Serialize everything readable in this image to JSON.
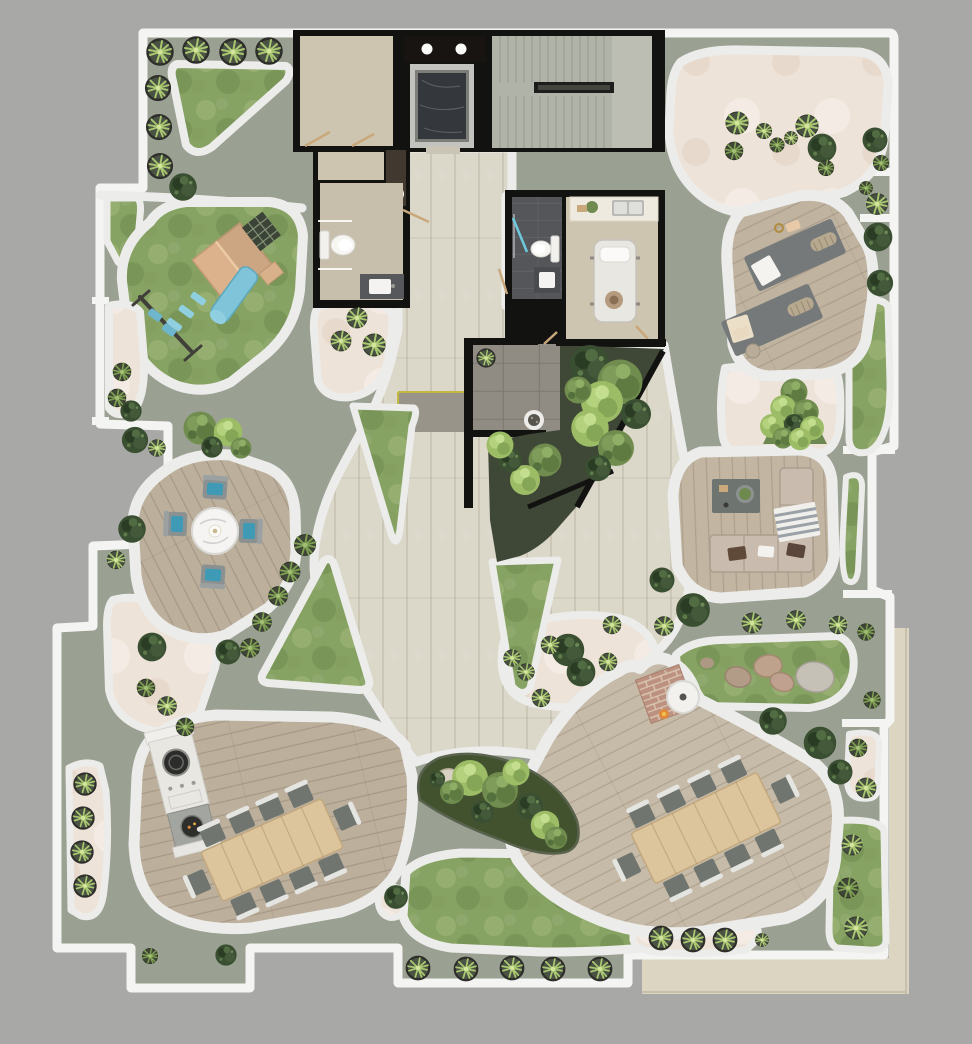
{
  "canvas": {
    "width": 972,
    "height": 1044
  },
  "colors": {
    "background": "#a8a8a6",
    "outside_roof": "#dcd5c2",
    "parapet": "#f4f4f2",
    "terrace_floor": "#9aa092",
    "walkway": "#ececea",
    "paver": "#dbd7c9",
    "sand": "#eee3d8",
    "lawn": "#87a364",
    "deck_wood": "#bcb09d",
    "deck_wood_light": "#c6bba8",
    "table_wood": "#dcc49c",
    "building_wall": "#121211",
    "room_beige": "#cec5b0",
    "room_beige_2": "#c7beab",
    "slate": "#54565a",
    "stair": "#b0b3a7",
    "court_tile": "#908c83",
    "soil": "#3f4836",
    "marble_dark": "#34373b",
    "metal": "#c2c2bf",
    "chair_gray": "#70756f",
    "cushion_blue": "#3f9ab5",
    "accent_blue": "#7fc4d8",
    "sofa": "#c9bcae",
    "white_furniture": "#f2f1ee",
    "brick": "#bd9180",
    "boulder_tan": "#b79c88",
    "boulder_gray": "#c6c1b6",
    "accent_yellow": "#c3b93f"
  },
  "scene": {
    "description": "top-down architectural rendering of a rooftop amenity terrace around a central building core",
    "areas": [
      {
        "id": "building-core",
        "kind": "interior"
      },
      {
        "id": "elevator",
        "kind": "interior"
      },
      {
        "id": "staircase",
        "kind": "interior"
      },
      {
        "id": "bathroom-left",
        "kind": "interior"
      },
      {
        "id": "bathroom-slate",
        "kind": "interior"
      },
      {
        "id": "treatment-room",
        "kind": "interior"
      },
      {
        "id": "outdoor-shower-court",
        "kind": "patio"
      },
      {
        "id": "walled-garden",
        "kind": "planting"
      },
      {
        "id": "central-paver-plaza",
        "kind": "paving"
      },
      {
        "id": "playground-lawn",
        "kind": "lawn"
      },
      {
        "id": "round-dining-deck",
        "kind": "deck"
      },
      {
        "id": "bbq-dining-deck",
        "kind": "deck"
      },
      {
        "id": "fire-pit-dining-deck",
        "kind": "deck"
      },
      {
        "id": "lounge-deck",
        "kind": "deck"
      },
      {
        "id": "yoga-deck",
        "kind": "deck"
      },
      {
        "id": "zen-sand-garden",
        "kind": "sand"
      },
      {
        "id": "rock-garden-lawn",
        "kind": "lawn"
      },
      {
        "id": "bottom-lawn",
        "kind": "lawn"
      },
      {
        "id": "teardrop-planting-bed",
        "kind": "planting"
      }
    ],
    "furniture": [
      "playhouse-with-slide",
      "swing-set",
      "round-marble-table",
      "four-blue-cushion-chairs",
      "bbq-island",
      "dining-table-10-seats-west",
      "dining-table-10-seats-east",
      "fire-pit-table",
      "l-shaped-sofa",
      "coffee-table",
      "two-yoga-mats",
      "massage-table",
      "kitchenette",
      "toilet-x2",
      "vanity-x2",
      "shower-drain"
    ],
    "plants": [
      {
        "type": "pota",
        "x": 160,
        "y": 52,
        "s": 1
      },
      {
        "type": "pota",
        "x": 196,
        "y": 50,
        "s": 1
      },
      {
        "type": "pota",
        "x": 233,
        "y": 52,
        "s": 1
      },
      {
        "type": "pota",
        "x": 269,
        "y": 51,
        "s": 1
      },
      {
        "type": "pota",
        "x": 158,
        "y": 88,
        "s": 0.95
      },
      {
        "type": "pota",
        "x": 159,
        "y": 127,
        "s": 0.95
      },
      {
        "type": "pota",
        "x": 160,
        "y": 166,
        "s": 0.95
      },
      {
        "type": "bush",
        "x": 183,
        "y": 187,
        "s": 1.1
      },
      {
        "type": "agaved",
        "x": 122,
        "y": 372,
        "s": 0.8
      },
      {
        "type": "agaved",
        "x": 117,
        "y": 398,
        "s": 0.8
      },
      {
        "type": "bush",
        "x": 131,
        "y": 411,
        "s": 0.85
      },
      {
        "type": "bush",
        "x": 135,
        "y": 440,
        "s": 1.05
      },
      {
        "type": "agave",
        "x": 157,
        "y": 448,
        "s": 0.75
      },
      {
        "type": "treeo",
        "x": 200,
        "y": 428,
        "s": 1.1
      },
      {
        "type": "treel",
        "x": 228,
        "y": 432,
        "s": 0.95
      },
      {
        "type": "bush",
        "x": 212,
        "y": 447,
        "s": 0.85
      },
      {
        "type": "treeo",
        "x": 241,
        "y": 448,
        "s": 0.7
      },
      {
        "type": "agave",
        "x": 357,
        "y": 318,
        "s": 0.9
      },
      {
        "type": "agave",
        "x": 341,
        "y": 341,
        "s": 0.9
      },
      {
        "type": "agave",
        "x": 374,
        "y": 345,
        "s": 1
      },
      {
        "type": "agaved",
        "x": 305,
        "y": 545,
        "s": 0.95
      },
      {
        "type": "agaved",
        "x": 290,
        "y": 572,
        "s": 0.9
      },
      {
        "type": "agaved",
        "x": 278,
        "y": 596,
        "s": 0.85
      },
      {
        "type": "agaved",
        "x": 262,
        "y": 622,
        "s": 0.85
      },
      {
        "type": "agaved",
        "x": 250,
        "y": 648,
        "s": 0.85
      },
      {
        "type": "bush",
        "x": 228,
        "y": 652,
        "s": 1
      },
      {
        "type": "bush",
        "x": 132,
        "y": 529,
        "s": 1.1
      },
      {
        "type": "agave",
        "x": 116,
        "y": 560,
        "s": 0.8
      },
      {
        "type": "bush",
        "x": 152,
        "y": 647,
        "s": 1.15
      },
      {
        "type": "agaved",
        "x": 146,
        "y": 688,
        "s": 0.8
      },
      {
        "type": "agave",
        "x": 167,
        "y": 706,
        "s": 0.85
      },
      {
        "type": "agaved",
        "x": 185,
        "y": 727,
        "s": 0.8
      },
      {
        "type": "pota",
        "x": 85,
        "y": 784,
        "s": 0.85
      },
      {
        "type": "pota",
        "x": 83,
        "y": 818,
        "s": 0.85
      },
      {
        "type": "pota",
        "x": 82,
        "y": 852,
        "s": 0.85
      },
      {
        "type": "pota",
        "x": 85,
        "y": 886,
        "s": 0.85
      },
      {
        "type": "bush",
        "x": 226,
        "y": 955,
        "s": 0.85
      },
      {
        "type": "agaved",
        "x": 150,
        "y": 956,
        "s": 0.7
      },
      {
        "type": "bush",
        "x": 590,
        "y": 365,
        "s": 1.6
      },
      {
        "type": "treeo",
        "x": 620,
        "y": 382,
        "s": 1.5
      },
      {
        "type": "treel",
        "x": 602,
        "y": 402,
        "s": 1.4
      },
      {
        "type": "bush",
        "x": 636,
        "y": 414,
        "s": 1.2
      },
      {
        "type": "treel",
        "x": 590,
        "y": 428,
        "s": 1.25
      },
      {
        "type": "treeo",
        "x": 616,
        "y": 448,
        "s": 1.2
      },
      {
        "type": "bush",
        "x": 598,
        "y": 468,
        "s": 1.05
      },
      {
        "type": "treeo",
        "x": 578,
        "y": 390,
        "s": 0.9
      },
      {
        "type": "treeo",
        "x": 545,
        "y": 460,
        "s": 1.1
      },
      {
        "type": "treel",
        "x": 525,
        "y": 480,
        "s": 1
      },
      {
        "type": "bush",
        "x": 510,
        "y": 460,
        "s": 0.95
      },
      {
        "type": "treel",
        "x": 500,
        "y": 445,
        "s": 0.9
      },
      {
        "type": "treel",
        "x": 470,
        "y": 778,
        "s": 1.2
      },
      {
        "type": "treeo",
        "x": 500,
        "y": 790,
        "s": 1.2
      },
      {
        "type": "bush",
        "x": 530,
        "y": 806,
        "s": 1.05
      },
      {
        "type": "treel",
        "x": 545,
        "y": 825,
        "s": 0.95
      },
      {
        "type": "treeo",
        "x": 452,
        "y": 792,
        "s": 0.8
      },
      {
        "type": "bush",
        "x": 482,
        "y": 812,
        "s": 0.9
      },
      {
        "type": "treel",
        "x": 516,
        "y": 772,
        "s": 0.9
      },
      {
        "type": "treeo",
        "x": 556,
        "y": 838,
        "s": 0.75
      },
      {
        "type": "bush",
        "x": 437,
        "y": 779,
        "s": 0.65
      },
      {
        "type": "bush",
        "x": 396,
        "y": 897,
        "s": 0.95
      },
      {
        "type": "pota",
        "x": 418,
        "y": 968,
        "s": 0.9
      },
      {
        "type": "pota",
        "x": 466,
        "y": 969,
        "s": 0.9
      },
      {
        "type": "pota",
        "x": 512,
        "y": 968,
        "s": 0.9
      },
      {
        "type": "pota",
        "x": 553,
        "y": 969,
        "s": 0.9
      },
      {
        "type": "pota",
        "x": 600,
        "y": 969,
        "s": 0.9
      },
      {
        "type": "pota",
        "x": 661,
        "y": 938,
        "s": 0.9
      },
      {
        "type": "pota",
        "x": 693,
        "y": 940,
        "s": 0.9
      },
      {
        "type": "pota",
        "x": 725,
        "y": 940,
        "s": 0.9
      },
      {
        "type": "agave",
        "x": 762,
        "y": 940,
        "s": 0.6
      },
      {
        "type": "bush",
        "x": 568,
        "y": 650,
        "s": 1.3
      },
      {
        "type": "bush",
        "x": 581,
        "y": 672,
        "s": 1.15
      },
      {
        "type": "agave",
        "x": 612,
        "y": 625,
        "s": 0.8
      },
      {
        "type": "agave",
        "x": 550,
        "y": 645,
        "s": 0.8
      },
      {
        "type": "agave",
        "x": 608,
        "y": 662,
        "s": 0.8
      },
      {
        "type": "agave",
        "x": 526,
        "y": 672,
        "s": 0.75
      },
      {
        "type": "agave",
        "x": 541,
        "y": 698,
        "s": 0.8
      },
      {
        "type": "agave",
        "x": 512,
        "y": 658,
        "s": 0.75
      },
      {
        "type": "bush",
        "x": 662,
        "y": 580,
        "s": 1
      },
      {
        "type": "bush",
        "x": 693,
        "y": 610,
        "s": 1.35
      },
      {
        "type": "agave",
        "x": 664,
        "y": 626,
        "s": 0.85
      },
      {
        "type": "agave",
        "x": 752,
        "y": 623,
        "s": 0.9
      },
      {
        "type": "agave",
        "x": 796,
        "y": 620,
        "s": 0.85
      },
      {
        "type": "agave",
        "x": 838,
        "y": 625,
        "s": 0.8
      },
      {
        "type": "agaved",
        "x": 866,
        "y": 632,
        "s": 0.75
      },
      {
        "type": "bush",
        "x": 773,
        "y": 721,
        "s": 1.1
      },
      {
        "type": "bush",
        "x": 820,
        "y": 743,
        "s": 1.3
      },
      {
        "type": "bush",
        "x": 840,
        "y": 772,
        "s": 1
      },
      {
        "type": "agaved",
        "x": 872,
        "y": 700,
        "s": 0.75
      },
      {
        "type": "agaved",
        "x": 858,
        "y": 748,
        "s": 0.8
      },
      {
        "type": "agave",
        "x": 866,
        "y": 788,
        "s": 0.9
      },
      {
        "type": "agave",
        "x": 852,
        "y": 845,
        "s": 0.9
      },
      {
        "type": "agaved",
        "x": 848,
        "y": 888,
        "s": 0.9
      },
      {
        "type": "agave",
        "x": 856,
        "y": 928,
        "s": 1
      },
      {
        "type": "agave",
        "x": 737,
        "y": 123,
        "s": 1
      },
      {
        "type": "agave",
        "x": 764,
        "y": 131,
        "s": 0.7
      },
      {
        "type": "agave",
        "x": 807,
        "y": 126,
        "s": 1
      },
      {
        "type": "agaved",
        "x": 777,
        "y": 145,
        "s": 0.65
      },
      {
        "type": "agave",
        "x": 791,
        "y": 138,
        "s": 0.6
      },
      {
        "type": "bush",
        "x": 822,
        "y": 148,
        "s": 1.15
      },
      {
        "type": "agaved",
        "x": 734,
        "y": 151,
        "s": 0.8
      },
      {
        "type": "agaved",
        "x": 826,
        "y": 168,
        "s": 0.7
      },
      {
        "type": "bush",
        "x": 875,
        "y": 140,
        "s": 1
      },
      {
        "type": "agaved",
        "x": 881,
        "y": 163,
        "s": 0.7
      },
      {
        "type": "agaved",
        "x": 866,
        "y": 188,
        "s": 0.6
      },
      {
        "type": "agave",
        "x": 877,
        "y": 204,
        "s": 0.95
      },
      {
        "type": "bush",
        "x": 878,
        "y": 237,
        "s": 1.15
      },
      {
        "type": "bush",
        "x": 880,
        "y": 283,
        "s": 1.05
      },
      {
        "type": "treeo",
        "x": 794,
        "y": 392,
        "s": 0.9
      },
      {
        "type": "treel",
        "x": 783,
        "y": 408,
        "s": 0.85
      },
      {
        "type": "treeo",
        "x": 806,
        "y": 412,
        "s": 0.85
      },
      {
        "type": "treel",
        "x": 772,
        "y": 426,
        "s": 0.8
      },
      {
        "type": "bush",
        "x": 794,
        "y": 424,
        "s": 0.8
      },
      {
        "type": "treel",
        "x": 812,
        "y": 428,
        "s": 0.8
      },
      {
        "type": "treeo",
        "x": 783,
        "y": 438,
        "s": 0.7
      },
      {
        "type": "treel",
        "x": 800,
        "y": 439,
        "s": 0.75
      },
      {
        "type": "pota",
        "x": 486,
        "y": 358,
        "s": 0.7
      }
    ]
  }
}
